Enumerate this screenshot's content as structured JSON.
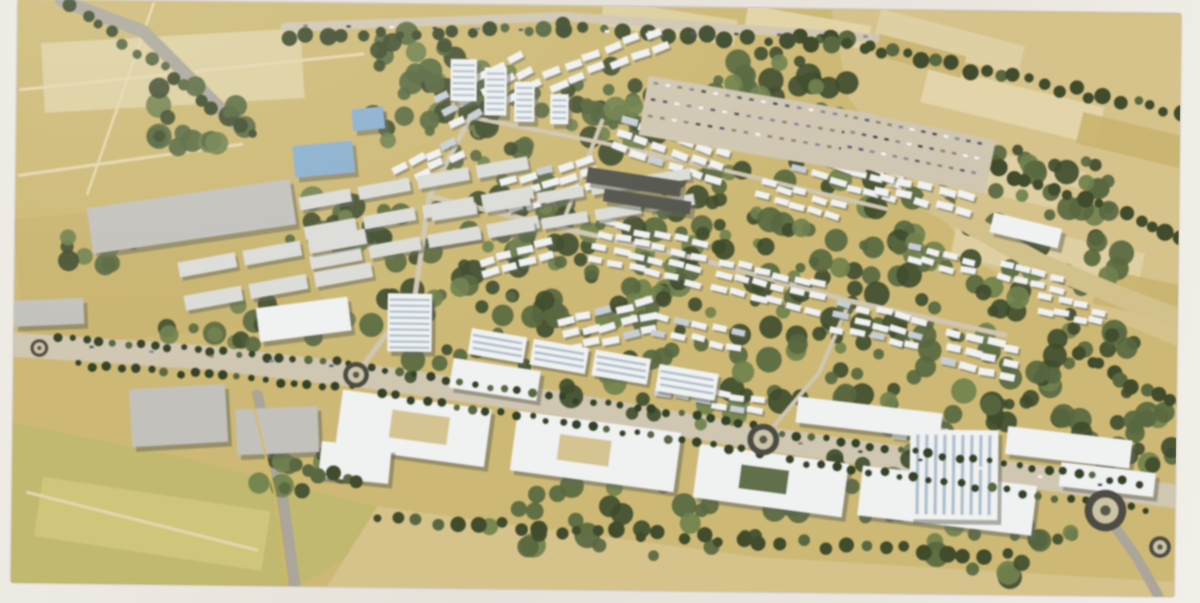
{
  "meta": {
    "title": "Aerial masterplan rendering",
    "description": "Photograph of a printed aerial architectural rendering of a master-planned community: dense clusters of white low-rise housing set in green landscaping, a palm-lined boulevard with roundabouts, large white commercial buildings and a high-rise tower in the foreground, gray warehouses to the west, and tan agricultural fields surrounding the site."
  },
  "artwork": {
    "legend": "patches/courtyards=[x,y,w,h,angle,fillKey] clusters=[x,y,angle,rows,cols,w,h,gapX,gapY] forest=[cx,cy,rx,ry,count] treeRows/palmRows=[x1,y1,x2,y2,count] bigBuildings=[x,y,w,h,angle,fillKey] towers=[x,y,w,h,stripeDir] roundabouts=[x,y,r] parkingLots=[x,y,w,h,angle,rows,cols] carLines=[x1,y1,x2,y2,count]",
    "canvas": {
      "x": 14,
      "y": 5,
      "w": 1164,
      "h": 586,
      "rotation_deg": 0.7
    },
    "palette": {
      "paper": "#e9e5de",
      "base": "#cdb76c",
      "fieldLight": "#dfcf9e",
      "fieldMid": "#d6c184",
      "fieldDark": "#c9b166",
      "dirt": "#e4d5a6",
      "meadow": "#c0b766",
      "meadowLight": "#cfc674",
      "roadLight": "#cfc5ae",
      "roadGray": "#a9a496",
      "asphalt": "#6b675c",
      "greenDark": "#3c4a28",
      "greenMid": "#54663a",
      "greenLight": "#6d7f46",
      "palm": "#2f4022",
      "white": "#eef0f0",
      "whiteShade": "#c5cdd4",
      "shadow": "#5f6353",
      "blueGlass": "#85aed0",
      "blueWin": "#9db4c6",
      "grayBldg": "#c0bfba",
      "darkRoof": "#52534a",
      "tan": "#d3bf85",
      "yellowLine": "#d8b84a",
      "carColors": [
        "#3d4045",
        "#f2f2f2",
        "#7b8894",
        "#46586e",
        "#8b7f66"
      ]
    },
    "fields": [
      {
        "fill": "fieldMid",
        "pts": [
          [
            828,
            6
          ],
          [
            1180,
            6
          ],
          [
            1180,
            340
          ],
          [
            980,
            260
          ],
          [
            846,
            94
          ]
        ]
      },
      {
        "fill": "meadow",
        "pts": [
          [
            14,
            430
          ],
          [
            180,
            462
          ],
          [
            420,
            520
          ],
          [
            300,
            592
          ],
          [
            14,
            592
          ]
        ]
      },
      {
        "fill": "fieldMid",
        "pts": [
          [
            330,
            592
          ],
          [
            380,
            510
          ],
          [
            760,
            556
          ],
          [
            1180,
            576
          ],
          [
            1180,
            592
          ]
        ]
      }
    ],
    "patches": [
      [
        872,
        22,
        150,
        30,
        14,
        "fieldLight"
      ],
      [
        1018,
        48,
        160,
        34,
        14,
        "fieldMid"
      ],
      [
        920,
        80,
        180,
        38,
        13,
        "dirt"
      ],
      [
        1076,
        118,
        115,
        32,
        13,
        "fieldDark"
      ],
      [
        893,
        146,
        190,
        42,
        12,
        "fieldLight"
      ],
      [
        1055,
        192,
        135,
        38,
        12,
        "fieldMid"
      ],
      [
        952,
        228,
        190,
        42,
        11,
        "fieldLight"
      ],
      [
        1095,
        272,
        105,
        36,
        11,
        "fieldDark"
      ],
      [
        598,
        8,
        135,
        26,
        8,
        "fieldLight"
      ],
      [
        742,
        12,
        125,
        24,
        9,
        "dirt"
      ],
      [
        872,
        40,
        90,
        22,
        14,
        "fieldDark"
      ],
      [
        18,
        210,
        300,
        130,
        -6,
        "fieldDark"
      ],
      [
        40,
        40,
        260,
        70,
        -4,
        "fieldLight"
      ],
      [
        40,
        500,
        230,
        60,
        8,
        "meadowLight"
      ]
    ],
    "roadsUnder": [
      {
        "w": 3,
        "c": "dirt",
        "pts": [
          [
            18,
            96
          ],
          [
            360,
            56
          ]
        ]
      },
      {
        "w": 3,
        "c": "dirt",
        "pts": [
          [
            18,
            182
          ],
          [
            240,
            148
          ]
        ]
      },
      {
        "w": 2.5,
        "c": "dirt",
        "pts": [
          [
            150,
            8
          ],
          [
            86,
            200
          ]
        ]
      },
      {
        "w": 3,
        "c": "dirt",
        "pts": [
          [
            30,
            500
          ],
          [
            260,
            555
          ]
        ]
      },
      {
        "w": 13,
        "c": "roadGray",
        "pts": [
          [
            58,
            6
          ],
          [
            140,
            36
          ],
          [
            238,
            132
          ]
        ]
      },
      {
        "w": 9,
        "c": "roadLight",
        "pts": [
          [
            282,
            30
          ],
          [
            560,
            16
          ],
          [
            872,
            34
          ]
        ]
      },
      {
        "w": 24,
        "c": "roadLight",
        "pts": [
          [
            14,
            352
          ],
          [
            200,
            362
          ],
          [
            357,
            378
          ],
          [
            560,
            404
          ],
          [
            765,
            437
          ],
          [
            950,
            461
          ],
          [
            1178,
            490
          ]
        ]
      },
      {
        "w": 12,
        "c": "roadGray",
        "pts": [
          [
            258,
            400
          ],
          [
            284,
            498
          ],
          [
            298,
            590
          ]
        ]
      },
      {
        "w": 10,
        "c": "roadGray",
        "pts": [
          [
            1106,
            505
          ],
          [
            1140,
            552
          ],
          [
            1162,
            590
          ]
        ]
      }
    ],
    "forest": [
      [
        520,
        120,
        150,
        55,
        55
      ],
      [
        700,
        92,
        150,
        48,
        45
      ],
      [
        560,
        250,
        175,
        75,
        65
      ],
      [
        780,
        220,
        150,
        65,
        50
      ],
      [
        880,
        300,
        130,
        65,
        45
      ],
      [
        700,
        360,
        175,
        65,
        50
      ],
      [
        460,
        330,
        115,
        55,
        35
      ],
      [
        950,
        382,
        115,
        55,
        35
      ],
      [
        1062,
        300,
        85,
        75,
        40
      ],
      [
        1025,
        185,
        95,
        48,
        30
      ],
      [
        870,
        482,
        115,
        45,
        30
      ],
      [
        625,
        520,
        145,
        38,
        26
      ],
      [
        245,
        330,
        85,
        28,
        18
      ],
      [
        185,
        120,
        65,
        32,
        16
      ],
      [
        345,
        232,
        65,
        38,
        18
      ],
      [
        1122,
        422,
        65,
        48,
        26
      ],
      [
        95,
        252,
        38,
        22,
        10
      ],
      [
        415,
        55,
        55,
        22,
        12
      ],
      [
        1005,
        545,
        90,
        28,
        16
      ],
      [
        305,
        475,
        60,
        20,
        12
      ]
    ],
    "treeRows": [
      [
        800,
        30,
        1178,
        106,
        26
      ],
      [
        858,
        118,
        1180,
        228,
        24
      ],
      [
        70,
        10,
        248,
        138,
        15
      ],
      [
        286,
        40,
        560,
        26,
        16
      ],
      [
        560,
        26,
        868,
        42,
        16
      ],
      [
        1080,
        350,
        1180,
        400,
        10
      ]
    ],
    "roadsOver": [
      {
        "w": 5,
        "c": "roadLight",
        "pts": [
          [
            357,
            378
          ],
          [
            415,
            298
          ],
          [
            428,
            198
          ],
          [
            468,
            118
          ]
        ]
      },
      {
        "w": 5,
        "c": "roadLight",
        "pts": [
          [
            428,
            198
          ],
          [
            560,
            228
          ],
          [
            700,
            258
          ],
          [
            850,
            298
          ],
          [
            1005,
            330
          ]
        ]
      },
      {
        "w": 4,
        "c": "roadLight",
        "pts": [
          [
            468,
            118
          ],
          [
            600,
            142
          ],
          [
            740,
            172
          ],
          [
            885,
            205
          ]
        ]
      },
      {
        "w": 4,
        "c": "roadLight",
        "pts": [
          [
            560,
            228
          ],
          [
            600,
            120
          ]
        ]
      },
      {
        "w": 4,
        "c": "roadLight",
        "pts": [
          [
            765,
            437
          ],
          [
            820,
            370
          ],
          [
            850,
            298
          ]
        ]
      },
      {
        "w": 20,
        "c": "tan",
        "pts": [
          [
            930,
            198
          ],
          [
            1040,
            258
          ],
          [
            1120,
            290
          ],
          [
            1180,
            312
          ]
        ]
      }
    ],
    "clusters": [
      [
        432,
        95,
        -28,
        3,
        5,
        16,
        7,
        21,
        15
      ],
      [
        540,
        68,
        -22,
        2,
        6,
        17,
        7,
        22,
        15
      ],
      [
        618,
        118,
        18,
        3,
        6,
        15,
        7,
        20,
        14
      ],
      [
        718,
        94,
        14,
        2,
        7,
        15,
        6,
        19,
        13
      ],
      [
        798,
        140,
        16,
        3,
        6,
        15,
        6,
        19,
        13
      ],
      [
        878,
        170,
        14,
        2,
        5,
        16,
        7,
        20,
        14
      ],
      [
        498,
        180,
        -18,
        3,
        5,
        16,
        7,
        20,
        14
      ],
      [
        598,
        220,
        12,
        4,
        6,
        15,
        6,
        19,
        13
      ],
      [
        718,
        258,
        13,
        3,
        6,
        15,
        6,
        19,
        13
      ],
      [
        838,
        298,
        13,
        3,
        5,
        15,
        6,
        19,
        13
      ],
      [
        948,
        328,
        12,
        3,
        4,
        16,
        7,
        20,
        14
      ],
      [
        558,
        318,
        -14,
        3,
        5,
        16,
        7,
        20,
        14
      ],
      [
        658,
        378,
        10,
        2,
        6,
        15,
        6,
        19,
        13
      ],
      [
        478,
        258,
        -16,
        2,
        4,
        16,
        7,
        20,
        14
      ],
      [
        898,
        418,
        10,
        2,
        5,
        15,
        6,
        19,
        13
      ],
      [
        998,
        258,
        13,
        2,
        4,
        14,
        6,
        18,
        12
      ],
      [
        388,
        168,
        -26,
        2,
        4,
        15,
        7,
        19,
        14
      ],
      [
        758,
        178,
        15,
        2,
        5,
        14,
        6,
        18,
        12
      ],
      [
        908,
        240,
        13,
        2,
        4,
        14,
        6,
        18,
        12
      ],
      [
        655,
        315,
        11,
        2,
        5,
        15,
        6,
        19,
        13
      ],
      [
        1040,
        290,
        12,
        2,
        4,
        14,
        6,
        18,
        12
      ]
    ],
    "grayClusters": [
      [
        298,
        196,
        -11,
        3,
        4,
        52,
        13,
        60,
        30
      ],
      [
        178,
        262,
        -11,
        2,
        3,
        58,
        15,
        66,
        34
      ],
      [
        430,
        208,
        -10,
        2,
        5,
        46,
        11,
        54,
        26
      ]
    ],
    "bigBuildings": [
      [
        88,
        198,
        205,
        46,
        -9,
        "grayBldg"
      ],
      [
        585,
        173,
        95,
        16,
        8,
        "darkRoof"
      ],
      [
        602,
        194,
        88,
        13,
        8,
        "darkRoof"
      ],
      [
        292,
        146,
        60,
        32,
        -6,
        "blueGlass"
      ],
      [
        350,
        110,
        32,
        22,
        -6,
        "blueGlass"
      ],
      [
        340,
        402,
        150,
        58,
        7,
        "white"
      ],
      [
        515,
        422,
        165,
        60,
        7,
        "white"
      ],
      [
        698,
        452,
        150,
        54,
        7,
        "white"
      ],
      [
        862,
        472,
        175,
        50,
        6,
        "white"
      ],
      [
        132,
        392,
        96,
        58,
        -4,
        "grayBldg"
      ],
      [
        238,
        412,
        82,
        46,
        -3,
        "grayBldg"
      ],
      [
        322,
        448,
        70,
        36,
        5,
        "white"
      ],
      [
        798,
        402,
        145,
        26,
        6,
        "white"
      ],
      [
        1008,
        428,
        125,
        28,
        6,
        "white"
      ],
      [
        1062,
        462,
        95,
        24,
        6,
        "white"
      ],
      [
        990,
        215,
        70,
        20,
        13,
        "white"
      ],
      [
        14,
        306,
        70,
        26,
        -3,
        "grayBldg"
      ],
      [
        452,
        366,
        88,
        30,
        8,
        "white"
      ],
      [
        258,
        306,
        92,
        34,
        -8,
        "white"
      ]
    ],
    "courtyards": [
      [
        392,
        416,
        58,
        28,
        7,
        "tan"
      ],
      [
        560,
        438,
        52,
        26,
        7,
        "tan"
      ],
      [
        742,
        466,
        48,
        24,
        7,
        "greenMid"
      ]
    ],
    "stripedSlabs": [
      [
        470,
        334,
        56,
        26,
        9
      ],
      [
        532,
        344,
        56,
        26,
        9
      ],
      [
        594,
        354,
        56,
        26,
        9
      ],
      [
        658,
        368,
        60,
        27,
        9
      ]
    ],
    "towers": [
      [
        448,
        60,
        26,
        42,
        "h"
      ],
      [
        482,
        68,
        22,
        48,
        "h"
      ],
      [
        512,
        82,
        20,
        40,
        "h"
      ],
      [
        548,
        94,
        18,
        30,
        "h"
      ],
      [
        388,
        296,
        44,
        58,
        "h"
      ],
      [
        912,
        426,
        88,
        90,
        "v"
      ]
    ],
    "treeRowsLate": [
      [
        380,
        522,
        1008,
        552,
        32
      ],
      [
        300,
        473,
        360,
        483,
        6
      ]
    ],
    "palmRows": [
      [
        58,
        344,
        350,
        367,
        22
      ],
      [
        372,
        372,
        756,
        424,
        27
      ],
      [
        782,
        431,
        1140,
        477,
        25
      ],
      [
        80,
        371,
        352,
        391,
        20
      ],
      [
        382,
        397,
        760,
        451,
        26
      ],
      [
        792,
        459,
        1150,
        504,
        24
      ]
    ],
    "roundabouts": [
      [
        357,
        378,
        13
      ],
      [
        765,
        438,
        16
      ],
      [
        1108,
        505,
        21
      ],
      [
        40,
        355,
        9
      ],
      [
        1163,
        541,
        11
      ]
    ],
    "parkingLots": [
      [
        640,
        92,
        230,
        60,
        9,
        3,
        18
      ],
      [
        840,
        120,
        150,
        55,
        11,
        3,
        12
      ]
    ],
    "carLines": [
      [
        300,
        27,
        860,
        31,
        14
      ],
      [
        90,
        352,
        330,
        368,
        5
      ],
      [
        800,
        440,
        1100,
        478,
        6
      ]
    ],
    "accents": [
      {
        "w": 2,
        "c": "yellowLine",
        "pts": [
          [
            252,
            399
          ],
          [
            277,
            497
          ],
          [
            291,
            588
          ]
        ]
      }
    ]
  }
}
